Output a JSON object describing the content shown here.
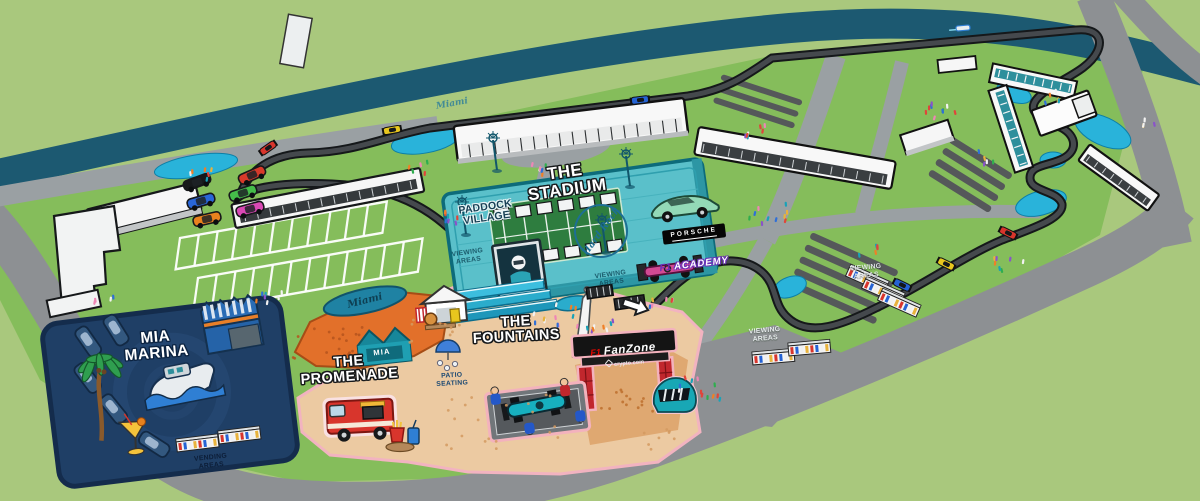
{
  "labels": {
    "stadium": {
      "line1": "THE",
      "line2": "STADIUM"
    },
    "paddock_village": {
      "line1": "PADDOCK",
      "line2": "VILLAGE"
    },
    "mia_marina": {
      "line1": "MIA",
      "line2": "MARINA"
    },
    "promenade": {
      "line1": "THE",
      "line2": "PROMENADE"
    },
    "fountains": {
      "line1": "THE",
      "line2": "FOUNTAINS"
    },
    "viewing_areas": {
      "line1": "VIEWING",
      "line2": "AREAS"
    },
    "vending_areas": {
      "line1": "VENDING",
      "line2": "AREAS"
    },
    "patio_seating": {
      "line1": "PATIO",
      "line2": "SEATING"
    }
  },
  "signs": {
    "porsche": "PORSCHE",
    "f1_academy": {
      "brand": "F1",
      "name": "ACADEMY"
    },
    "fanzone": {
      "brand": "F1",
      "name": "FanZone",
      "sponsor": "crypto.com"
    },
    "hard_rock": "Hard Rock",
    "mia_stand": "MIA",
    "miami_script": "Miami"
  },
  "colors": {
    "grass_outer": "#a9c87d",
    "grass_inner": "#85bd5b",
    "canal": "#1c5971",
    "road": "#8d9093",
    "track": "#45494d",
    "runoff_cyan": "#29b3da",
    "stadium_teal": "#5ac0ca",
    "marina_navy": "#1f3f66",
    "promenade_orange": "#e2702a",
    "sand": "#eccaa2",
    "sticker_pink": "#f3b2bd",
    "fanzone_red": "#c1272d",
    "helmet_teal": "#18a7b5",
    "academy_purple": "#6a30b8",
    "f1_red": "#e10600"
  },
  "icons": [
    "palm-tree-icon",
    "cocktail-icon",
    "yacht-icon",
    "boat-icon",
    "marina-building-icon",
    "food-truck-icon",
    "fries-icon",
    "drink-icon",
    "concession-tent-icon",
    "umbrella-icon",
    "fountain-icon",
    "obelisk-icon",
    "big-screen-icon",
    "awning-icon",
    "direction-arrow-icon",
    "fanzone-arch-icon",
    "racing-helmet-icon",
    "pit-crew-icon",
    "f1-car-icon",
    "sports-car-icon",
    "light-pole-icon",
    "grandstand-icon",
    "vending-stand-icon",
    "bridge-icon",
    "speedboat-icon",
    "hard-rock-logo-icon",
    "crypto-logo-icon"
  ]
}
